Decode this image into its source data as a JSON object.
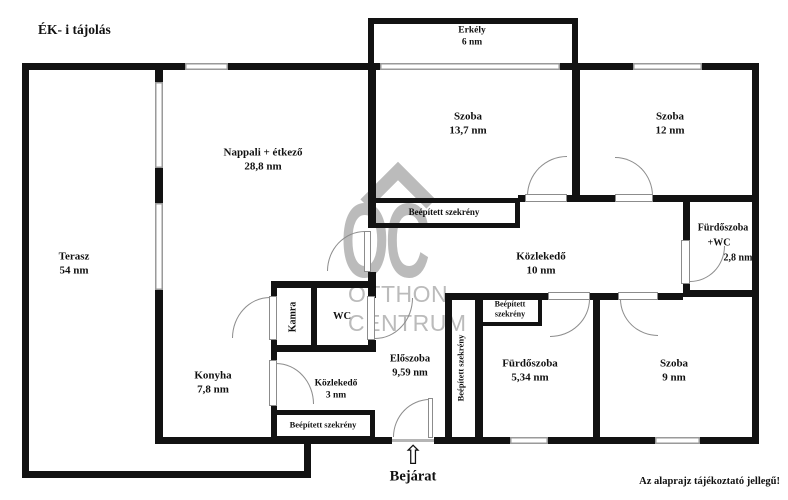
{
  "title": "ÉK- i tájolás",
  "disclaimer": "Az alaprajz tájékoztató jellegű!",
  "entrance": {
    "label": "Bejárat",
    "arrow_icon": "⇧"
  },
  "watermark": {
    "initials": "OC",
    "line1": "OTTHON",
    "line2": "CENTRUM"
  },
  "rooms": {
    "terasz": {
      "name": "Terasz",
      "area": "54 nm"
    },
    "nappali": {
      "name": "Nappali + étkező",
      "area": "28,8 nm"
    },
    "erkely": {
      "name": "Erkély",
      "area": "6 nm"
    },
    "szoba_nagy": {
      "name": "Szoba",
      "area": "13,7 nm"
    },
    "szoba_kozepes": {
      "name": "Szoba",
      "area": "12 nm"
    },
    "szoba_kis": {
      "name": "Szoba",
      "area": "9 nm"
    },
    "kozlekedo_fo": {
      "name": "Közlekedő",
      "area": "10 nm"
    },
    "kozlekedo_kis": {
      "name": "Közlekedő",
      "area": "3 nm"
    },
    "furdoszoba_wc": {
      "name": "Fürdőszoba",
      "name2": "+WC",
      "area": "2,8 nm"
    },
    "furdoszoba": {
      "name": "Fürdőszoba",
      "area": "5,34 nm"
    },
    "eloszoba": {
      "name": "Előszoba",
      "area": "9,59 nm"
    },
    "konyha": {
      "name": "Konyha",
      "area": "7,8 nm"
    },
    "kamra": {
      "name": "Kamra"
    },
    "wc": {
      "name": "WC"
    }
  },
  "closets": {
    "nappali": "Beépített szekrény",
    "konyha": "Beépített szekrény",
    "eloszoba_vertical": "Beépített szekrény",
    "furdoszoba_line1": "Beépített",
    "furdoszoba_line2": "szekrény"
  },
  "colors": {
    "wall": "#121212",
    "window_frame": "#9a9a9a",
    "door_arc": "#8c8c8c",
    "watermark": "#bbbbbb"
  }
}
